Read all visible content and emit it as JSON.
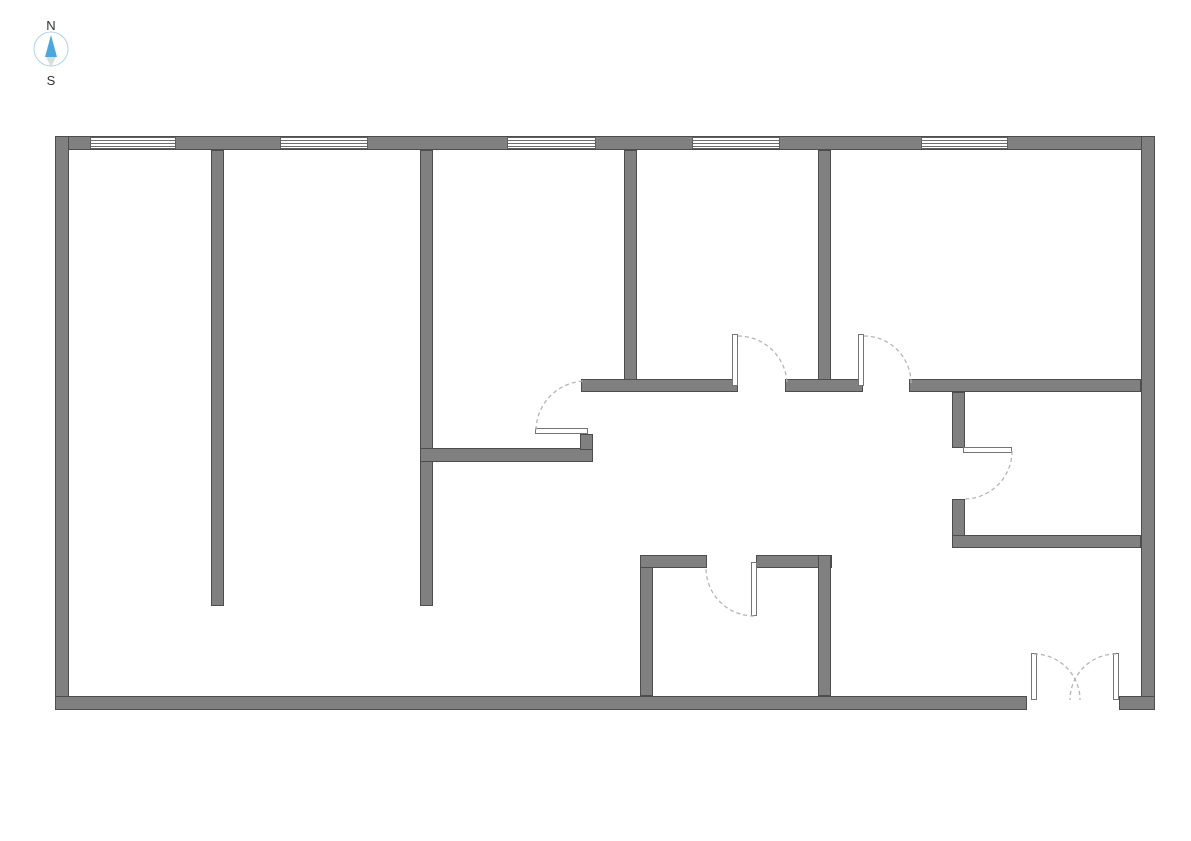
{
  "page": {
    "background": "#ffffff"
  },
  "compass": {
    "north_label": "N",
    "south_label": "S",
    "ring_color": "#aed3ec",
    "needle_north_color": "#4da7dc",
    "needle_south_color": "#d9dcdf",
    "label_color": "#333333"
  },
  "plan": {
    "wall_fill": "#808080",
    "wall_edge": "#4d4d4d",
    "window_line_color": "#6e6e6e",
    "door_arc_color": "#b5b5b5",
    "walls": [
      {
        "id": "outer-top",
        "x": 55,
        "y": 136,
        "w": 1100,
        "h": 14
      },
      {
        "id": "outer-left",
        "x": 55,
        "y": 136,
        "w": 14,
        "h": 574
      },
      {
        "id": "outer-right",
        "x": 1141,
        "y": 136,
        "w": 14,
        "h": 574
      },
      {
        "id": "outer-bottom-west",
        "x": 55,
        "y": 696,
        "w": 972,
        "h": 14
      },
      {
        "id": "outer-bottom-east",
        "x": 1119,
        "y": 696,
        "w": 36,
        "h": 14
      },
      {
        "id": "partition-west-1",
        "x": 211,
        "y": 150,
        "w": 13,
        "h": 456
      },
      {
        "id": "partition-west-2",
        "x": 420,
        "y": 150,
        "w": 13,
        "h": 456
      },
      {
        "id": "partition-mid-1",
        "x": 624,
        "y": 150,
        "w": 13,
        "h": 242
      },
      {
        "id": "partition-mid-2",
        "x": 818,
        "y": 150,
        "w": 13,
        "h": 242
      },
      {
        "id": "hall-north-west",
        "x": 581,
        "y": 379,
        "w": 157,
        "h": 13
      },
      {
        "id": "hall-north-mid",
        "x": 785,
        "y": 379,
        "w": 78,
        "h": 13
      },
      {
        "id": "hall-north-east",
        "x": 909,
        "y": 379,
        "w": 232,
        "h": 13
      },
      {
        "id": "corridor-stub",
        "x": 420,
        "y": 448,
        "w": 173,
        "h": 14
      },
      {
        "id": "corridor-stub-riser",
        "x": 580,
        "y": 434,
        "w": 13,
        "h": 16
      },
      {
        "id": "east-room-west-upper",
        "x": 952,
        "y": 392,
        "w": 13,
        "h": 56
      },
      {
        "id": "east-room-west-lower",
        "x": 952,
        "y": 499,
        "w": 13,
        "h": 49
      },
      {
        "id": "east-room-south",
        "x": 952,
        "y": 535,
        "w": 189,
        "h": 13
      },
      {
        "id": "south-room-west",
        "x": 640,
        "y": 555,
        "w": 13,
        "h": 141
      },
      {
        "id": "south-room-north-west",
        "x": 640,
        "y": 555,
        "w": 67,
        "h": 13
      },
      {
        "id": "south-room-north-east",
        "x": 756,
        "y": 555,
        "w": 76,
        "h": 13
      },
      {
        "id": "south-room-east",
        "x": 818,
        "y": 555,
        "w": 13,
        "h": 141
      }
    ],
    "windows": [
      {
        "id": "window-1",
        "x": 90,
        "y": 137,
        "w": 86,
        "h": 12
      },
      {
        "id": "window-2",
        "x": 280,
        "y": 137,
        "w": 88,
        "h": 12
      },
      {
        "id": "window-3",
        "x": 507,
        "y": 137,
        "w": 89,
        "h": 12
      },
      {
        "id": "window-4",
        "x": 692,
        "y": 137,
        "w": 88,
        "h": 12
      },
      {
        "id": "window-5",
        "x": 921,
        "y": 137,
        "w": 87,
        "h": 12
      }
    ],
    "door_leaves": [
      {
        "id": "hall-door-west-leaf",
        "x": 732,
        "y": 334,
        "w": 6,
        "h": 52
      },
      {
        "id": "hall-door-east-leaf",
        "x": 858,
        "y": 334,
        "w": 6,
        "h": 52
      },
      {
        "id": "corridor-door-leaf",
        "x": 535,
        "y": 428,
        "w": 53,
        "h": 6
      },
      {
        "id": "east-room-door-leaf",
        "x": 963,
        "y": 447,
        "w": 49,
        "h": 6
      },
      {
        "id": "south-room-door-leaf",
        "x": 751,
        "y": 562,
        "w": 6,
        "h": 54
      },
      {
        "id": "entrance-door-leaf-left",
        "x": 1031,
        "y": 653,
        "w": 6,
        "h": 47
      },
      {
        "id": "entrance-door-leaf-right",
        "x": 1113,
        "y": 653,
        "w": 6,
        "h": 47
      }
    ],
    "door_arcs": [
      {
        "id": "hall-door-west-arc",
        "d": "M 738 336 A 49 49 0 0 1 787 385"
      },
      {
        "id": "hall-door-east-arc",
        "d": "M 864 336 A 47 47 0 0 1 911 383"
      },
      {
        "id": "corridor-door-arc",
        "d": "M 536 430 A 50 50 0 0 1 586 381"
      },
      {
        "id": "east-room-door-arc",
        "d": "M 1012 451 A 48 48 0 0 1 964 499"
      },
      {
        "id": "south-room-door-arc",
        "d": "M 754 616 A 48 48 0 0 1 706 568"
      },
      {
        "id": "entrance-door-arc-left",
        "d": "M 1034 654 A 46 46 0 0 1 1080 700"
      },
      {
        "id": "entrance-door-arc-right",
        "d": "M 1116 654 A 46 46 0 0 0 1070 700"
      }
    ]
  }
}
